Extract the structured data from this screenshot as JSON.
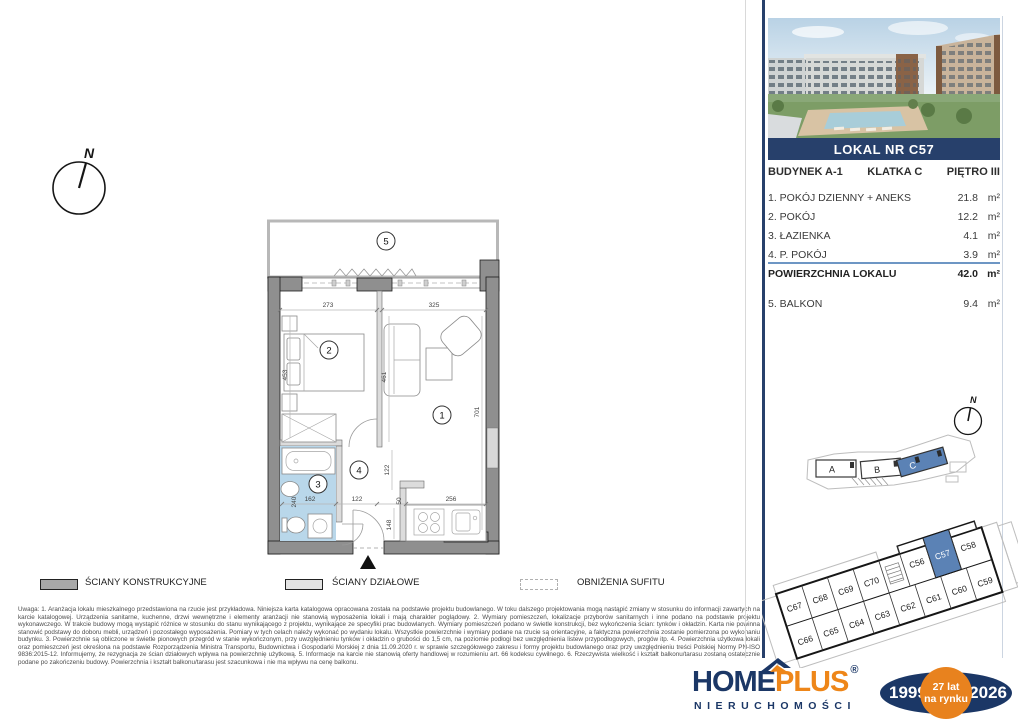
{
  "colors": {
    "navy": "#27406b",
    "logo_navy": "#1b3766",
    "orange": "#ee8619",
    "highlight_blue": "#5b82b5",
    "bathroom_blue": "#b9d7ea",
    "rule_blue": "#6d96c4"
  },
  "banner": {
    "text": "LOKAL NR C57"
  },
  "meta": {
    "budynek": "BUDYNEK A-1",
    "klatka": "KLATKA C",
    "pietro": "PIĘTRO III"
  },
  "area_table": {
    "rows": [
      {
        "label": "1. POKÓJ DZIENNY + ANEKS",
        "value": "21.8",
        "unit": "m²"
      },
      {
        "label": "2. POKÓJ",
        "value": "12.2",
        "unit": "m²"
      },
      {
        "label": "3. ŁAZIENKA",
        "value": "4.1",
        "unit": "m²"
      },
      {
        "label": "4. P. POKÓJ",
        "value": "3.9",
        "unit": "m²"
      }
    ],
    "total": {
      "label": "POWIERZCHNIA LOKALU",
      "value": "42.0",
      "unit": "m²"
    },
    "balcony": {
      "label": "5. BALKON",
      "value": "9.4",
      "unit": "m²"
    }
  },
  "floor_plan": {
    "room_numbers": {
      "r1": "1",
      "r2": "2",
      "r3": "3",
      "r4": "4",
      "r5": "5"
    },
    "dimensions": {
      "room2_width": "273",
      "room1_width": "325",
      "room2_depth": "453",
      "mid_wall": "461",
      "room1_depth": "701",
      "hall_depth": "122",
      "hall_width": "122",
      "bath_width": "162",
      "bath_depth": "240",
      "kitchen_gap": "50",
      "kitchen_width": "256",
      "kitchen_depth": "148"
    },
    "north": "N"
  },
  "site_plan": {
    "building_a": "A",
    "building_b": "B",
    "building_c": "C",
    "north": "N"
  },
  "unit_grid": {
    "top_row": [
      "C67",
      "C68",
      "C69",
      "C70",
      "C56",
      "C57",
      "C58"
    ],
    "bottom_row": [
      "C66",
      "C65",
      "C64",
      "C63",
      "C62",
      "C61",
      "C60",
      "C59"
    ],
    "highlighted": "C57"
  },
  "legend": {
    "item1": "ŚCIANY KONSTRUKCYJNE",
    "item2": "ŚCIANY DZIAŁOWE",
    "item3": "OBNIŻENIA SUFITU"
  },
  "disclaimer": "Uwaga:   1. Aranżacja lokalu mieszkalnego przedstawiona na rzucie jest przykładowa. Niniejsza karta katalogowa opracowana została na podstawie projektu budowlanego. W toku dalszego projektowania mogą nastąpić zmiany w stosunku do informacji zawartych na karcie katalogowej. Urządzenia sanitarne, kuchenne, drzwi wewnętrzne i elementy aranżacji nie stanowią wyposażenia lokali i mają charakter poglądowy.   2. Wymiary pomieszczeń, lokalizacje przyborów sanitarnych i inne podano na podstawie projektu wykonawczego. W trakcie budowy mogą wystąpić różnice w stosunku do stanu wynikającego z projektu, wynikające ze specyfiki prac budowlanych. Wymiary pomieszczeń podano w świetle konstrukcji, bez wykończenia ścian: tynków i okładzin. Karta nie powinna stanowić podstawy do doboru mebli, urządzeń i pozostałego wyposażenia. Pomiary w tych celach należy wykonać po wydaniu lokalu. Wszystkie powierzchnie i wymiary podane na rzucie są orientacyjne, a faktyczna powierzchnia zostanie pomierzona po wykonaniu budynku.   3. Powierzchnie są obliczone w świetle pionowych przegród w stanie wykończonym, przy uwzględnieniu tynków i okładzin o grubości do 1,5 cm, na poziomie podłogi bez uwzględnienia listew przypodłogowych, progów itp.   4. Powierzchnia użytkowa lokali oraz pomieszczeń jest określona na podstawie Rozporządzenia Ministra Transportu, Budownictwa i Gospodarki Morskiej z dnia 11.09.2020 r. w sprawie szczegółowego zakresu i formy projektu budowlanego oraz przy uwzględnieniu treści Polskiej Normy PN-ISO 9836:2015-12. Informujemy, że rezygnacja ze ścian działowych wpływa na powierzchnię użytkową.   5. Informacje na karcie nie stanowią oferty handlowej w rozumieniu art. 66 kodeksu cywilnego.   6. Rzeczywista wielkość i kształt balkonu/tarasu zostaną ostatecznie podane po zakończeniu budowy. Powierzchnia i kształt balkonu/tarasu jest szacunkowa i nie ma wpływu na cenę balkonu.",
  "footer": {
    "brand_home": "HOME",
    "brand_plus": "PLUS",
    "reg": "®",
    "subtitle": "NIERUCHOMOŚCI",
    "year_start": "1999",
    "badge_top": "27 lat",
    "badge_bottom": "na rynku",
    "year_end": "2026"
  }
}
